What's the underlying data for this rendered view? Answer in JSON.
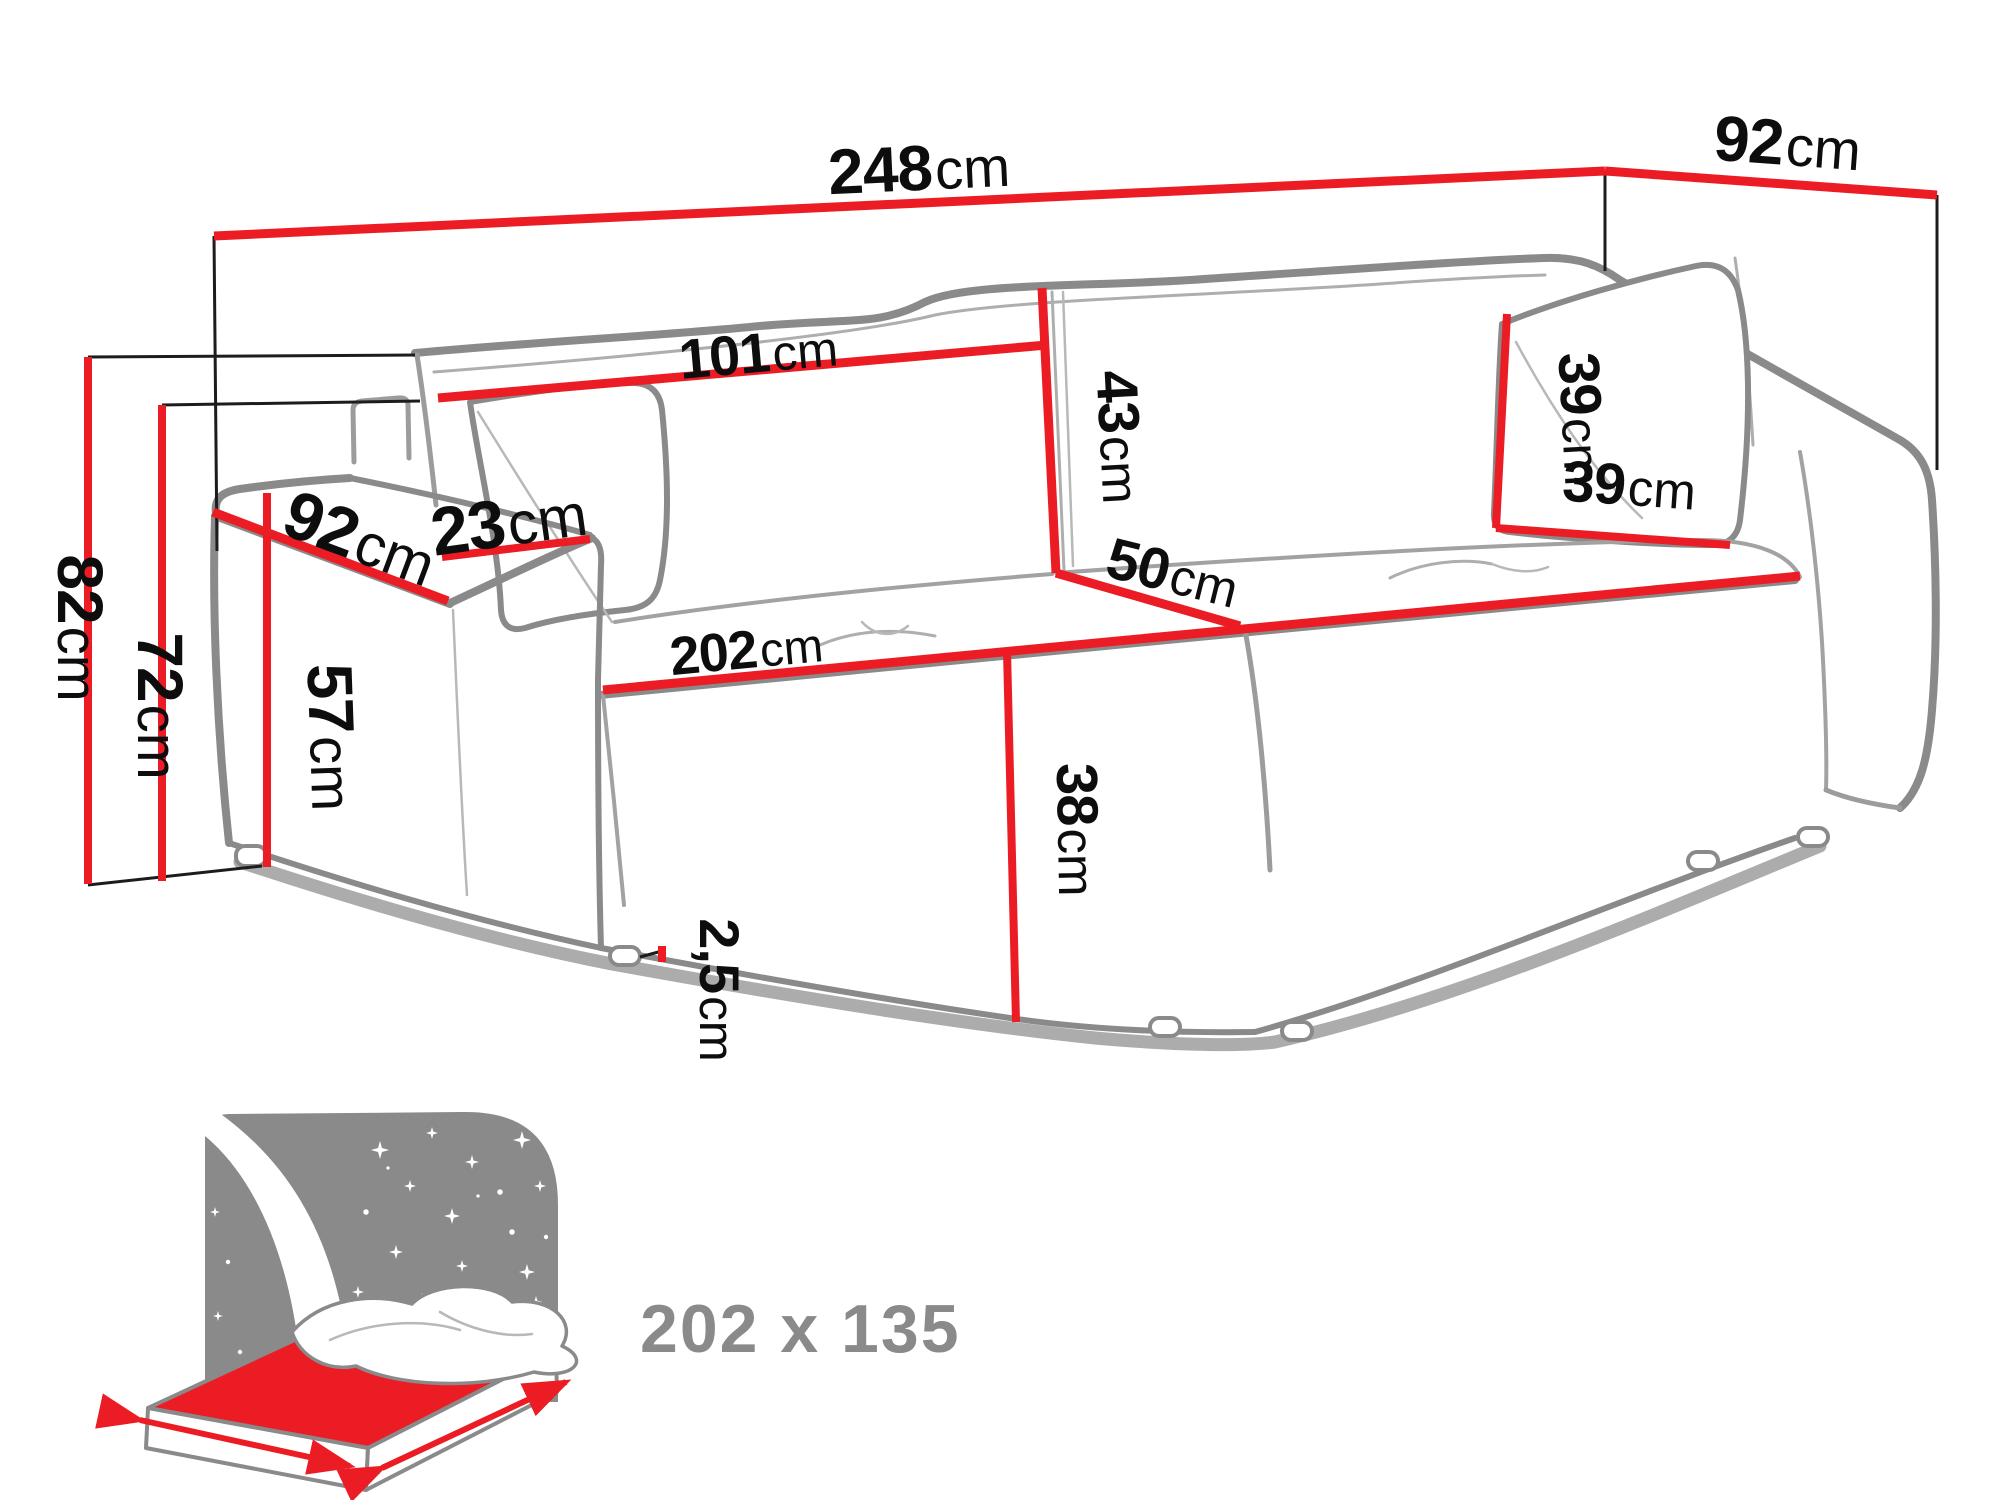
{
  "title": "Sofa bed dimension diagram",
  "colors": {
    "dimension_line": "#ec1c24",
    "outline_gray": "#8a8a8a",
    "label_text": "#0d0d0d",
    "icon_gray": "#8a8a8a",
    "background": "#ffffff"
  },
  "labels": {
    "width_total": {
      "value": "248",
      "unit": "cm"
    },
    "depth_total": {
      "value": "92",
      "unit": "cm"
    },
    "back_cushion_width": {
      "value": "101",
      "unit": "cm"
    },
    "back_cushion_height": {
      "value": "43",
      "unit": "cm"
    },
    "seat_depth": {
      "value": "50",
      "unit": "cm"
    },
    "pillow_height": {
      "value": "39",
      "unit": "cm"
    },
    "pillow_width": {
      "value": "39",
      "unit": "cm"
    },
    "armrest_depth": {
      "value": "92",
      "unit": "cm"
    },
    "armrest_width": {
      "value": "23",
      "unit": "cm"
    },
    "seat_width": {
      "value": "202",
      "unit": "cm"
    },
    "seat_height": {
      "value": "38",
      "unit": "cm"
    },
    "armrest_height": {
      "value": "57",
      "unit": "cm"
    },
    "frame_height": {
      "value": "72",
      "unit": "cm"
    },
    "total_height": {
      "value": "82",
      "unit": "cm"
    },
    "leg_height": {
      "value": "2,5",
      "unit": "cm"
    }
  },
  "sleeping_area": {
    "label": "202 x 135"
  }
}
